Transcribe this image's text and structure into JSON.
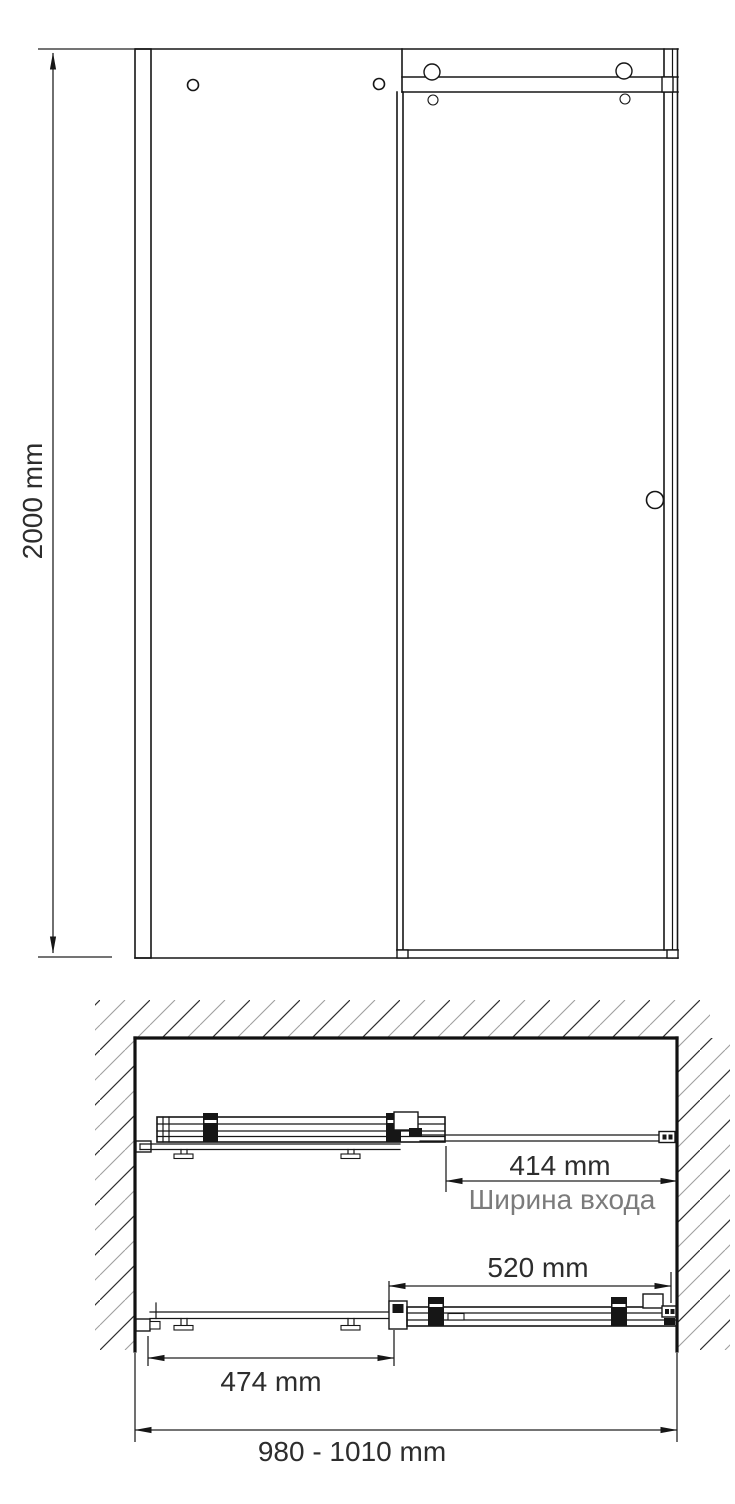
{
  "labels": {
    "height": "2000 mm",
    "entrance_width": "414 mm",
    "entrance_width_caption": "Ширина входа",
    "door_panel_width": "520 mm",
    "fixed_panel_width": "474 mm",
    "overall_width_range": "980 - 1010 mm"
  },
  "colors": {
    "line": "#161616",
    "dimension_text": "#2d2d2d",
    "caption_text": "#7b7b7b",
    "hatch_dark": "#2f2f2f",
    "hatch_light": "#9f9f9f",
    "background": "#ffffff"
  }
}
